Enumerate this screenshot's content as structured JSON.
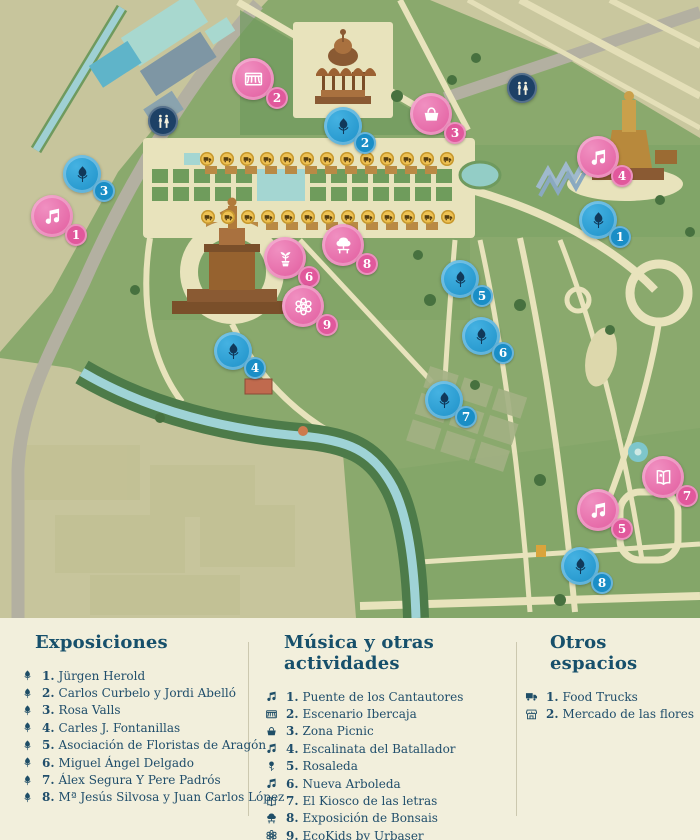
{
  "colors": {
    "expo_blue": "#1a8ec6",
    "music_pink": "#e1589c",
    "wc_navy": "#1d4166",
    "truck_yellow": "#eec152",
    "legend_text": "#204e6b",
    "heading": "#17506b",
    "map_green": "#8aa96d",
    "map_olive": "#c7c59c",
    "path_cream": "#e8e3bc"
  },
  "map": {
    "markers": [
      {
        "kind": "expo",
        "number": "1",
        "icon": "tulip-icon",
        "x": 598,
        "y": 220
      },
      {
        "kind": "expo",
        "number": "2",
        "icon": "tulip-icon",
        "x": 343,
        "y": 126
      },
      {
        "kind": "expo",
        "number": "3",
        "icon": "tulip-icon",
        "x": 82,
        "y": 174
      },
      {
        "kind": "expo",
        "number": "4",
        "icon": "tulip-icon",
        "x": 233,
        "y": 351
      },
      {
        "kind": "expo",
        "number": "5",
        "icon": "tulip-icon",
        "x": 460,
        "y": 279
      },
      {
        "kind": "expo",
        "number": "6",
        "icon": "tulip-icon",
        "x": 481,
        "y": 336
      },
      {
        "kind": "expo",
        "number": "7",
        "icon": "tulip-icon",
        "x": 444,
        "y": 400
      },
      {
        "kind": "expo",
        "number": "8",
        "icon": "tulip-icon",
        "x": 580,
        "y": 566
      },
      {
        "kind": "music",
        "number": "1",
        "icon": "music-icon",
        "x": 52,
        "y": 216
      },
      {
        "kind": "music",
        "number": "2",
        "icon": "stage-icon",
        "x": 253,
        "y": 79
      },
      {
        "kind": "music",
        "number": "3",
        "icon": "picnic-icon",
        "x": 431,
        "y": 114
      },
      {
        "kind": "music",
        "number": "4",
        "icon": "music-icon",
        "x": 598,
        "y": 157
      },
      {
        "kind": "music",
        "number": "5",
        "icon": "music-icon",
        "x": 598,
        "y": 510
      },
      {
        "kind": "music",
        "number": "6",
        "icon": "sapling-icon",
        "x": 285,
        "y": 258
      },
      {
        "kind": "music",
        "number": "7",
        "icon": "book-icon",
        "x": 663,
        "y": 477
      },
      {
        "kind": "music",
        "number": "8",
        "icon": "bonsai-icon",
        "x": 343,
        "y": 245
      },
      {
        "kind": "music",
        "number": "9",
        "icon": "flower-icon",
        "x": 303,
        "y": 306
      },
      {
        "kind": "wc",
        "number": "",
        "icon": "wc-icon",
        "x": 163,
        "y": 121
      },
      {
        "kind": "wc",
        "number": "",
        "icon": "wc-icon",
        "x": 522,
        "y": 88
      }
    ],
    "food_trucks": {
      "icon": "truck-icon",
      "rows": [
        {
          "y": 159,
          "x_start": 207,
          "count": 13,
          "step": 20
        },
        {
          "y": 217,
          "x_start": 208,
          "count": 13,
          "step": 20
        }
      ]
    }
  },
  "legend": {
    "columns": [
      {
        "title": "Exposiciones",
        "items": [
          {
            "num": "1.",
            "label": "Jürgen Herold",
            "icon": "tulip-icon"
          },
          {
            "num": "2.",
            "label": "Carlos Curbelo y Jordi Abelló",
            "icon": "tulip-icon"
          },
          {
            "num": "3.",
            "label": "Rosa Valls",
            "icon": "tulip-icon"
          },
          {
            "num": "4.",
            "label": "Carles J. Fontanillas",
            "icon": "tulip-icon"
          },
          {
            "num": "5.",
            "label": "Asociación de Floristas de Aragón",
            "icon": "tulip-icon"
          },
          {
            "num": "6.",
            "label": "Miguel Ángel Delgado",
            "icon": "tulip-icon"
          },
          {
            "num": "7.",
            "label": "Álex Segura Y Pere Padrós",
            "icon": "tulip-icon"
          },
          {
            "num": "8.",
            "label": "Mª Jesús Silvosa y Juan Carlos López",
            "icon": "tulip-icon"
          }
        ]
      },
      {
        "title": "Música y otras actividades",
        "items": [
          {
            "num": "1.",
            "label": "Puente de los Cantautores",
            "icon": "music-icon"
          },
          {
            "num": "2.",
            "label": "Escenario Ibercaja",
            "icon": "stage-icon"
          },
          {
            "num": "3.",
            "label": "Zona Picnic",
            "icon": "picnic-icon"
          },
          {
            "num": "4.",
            "label": "Escalinata del Batallador",
            "icon": "music-icon"
          },
          {
            "num": "5.",
            "label": "Rosaleda",
            "icon": "rose-icon"
          },
          {
            "num": "6.",
            "label": "Nueva Arboleda",
            "icon": "music-icon"
          },
          {
            "num": "7.",
            "label": "El Kiosco de las letras",
            "icon": "book-icon"
          },
          {
            "num": "8.",
            "label": "Exposición de Bonsais",
            "icon": "bonsai-icon"
          },
          {
            "num": "9.",
            "label": "EcoKids by Urbaser",
            "icon": "flower-icon"
          }
        ]
      },
      {
        "title": "Otros espacios",
        "items": [
          {
            "num": "1.",
            "label": "Food Trucks",
            "icon": "truck-icon"
          },
          {
            "num": "2.",
            "label": "Mercado de las flores",
            "icon": "market-icon"
          }
        ]
      }
    ]
  }
}
